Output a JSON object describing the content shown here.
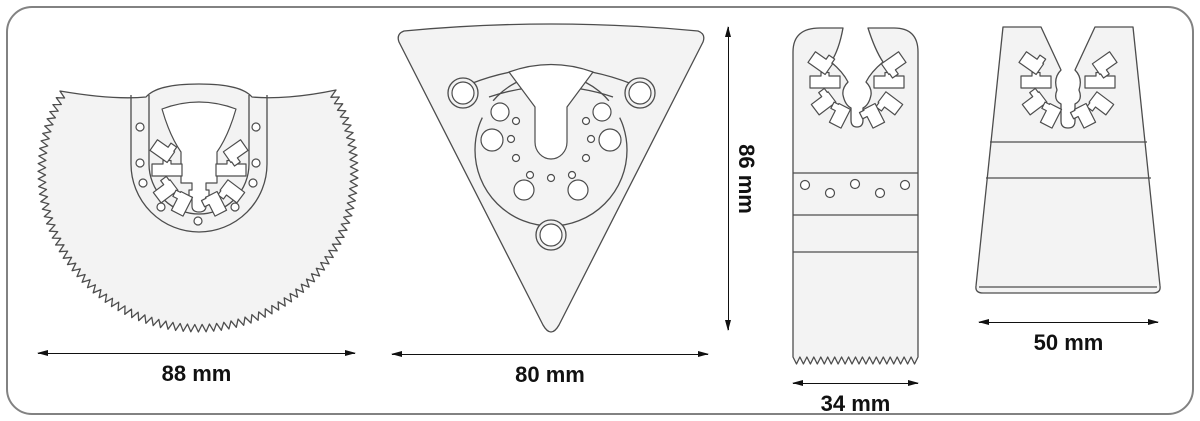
{
  "diagram": {
    "title": "oscillating-multitool-blade-set-dimensions",
    "colors": {
      "background": "#ffffff",
      "frame_border": "#828282",
      "outline": "#4d4d4d",
      "fill": "#f3f3f3",
      "dimension": "#111111"
    },
    "blades": [
      {
        "name": "segment-saw-blade",
        "width_label": "88 mm"
      },
      {
        "name": "triangular-delta-pad",
        "width_label": "80 mm",
        "height_label": "86 mm"
      },
      {
        "name": "plunge-cut-saw-blade",
        "width_label": "34 mm"
      },
      {
        "name": "rigid-scraper-blade",
        "width_label": "50 mm"
      }
    ]
  }
}
